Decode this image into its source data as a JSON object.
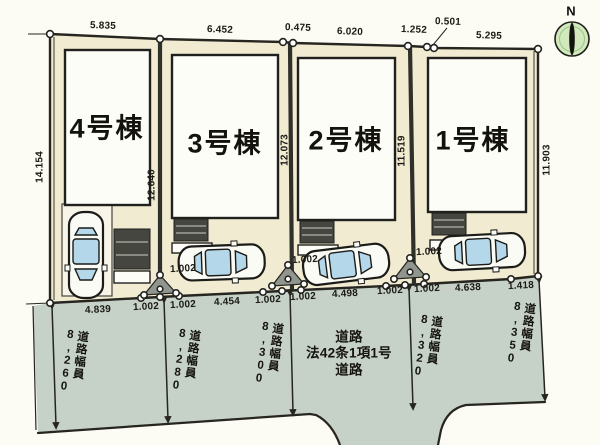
{
  "compass": {
    "north_label": "N"
  },
  "buildings": [
    {
      "label": "4号棟"
    },
    {
      "label": "3号棟"
    },
    {
      "label": "2号棟"
    },
    {
      "label": "1号棟"
    }
  ],
  "dimensions": {
    "top": [
      "5.835",
      "6.452",
      "0.475",
      "6.020",
      "1.252",
      "0.501",
      "5.295"
    ],
    "left_side": "14.154",
    "right_side": "11.903",
    "boundary_4_3": "12.640",
    "boundary_3_2": "12.073",
    "boundary_2_1": "11.519",
    "bottom": [
      "4.839",
      "1.002",
      "1.002",
      "4.454",
      "1.002",
      "1.002",
      "4.498",
      "1.002",
      "1.002",
      "4.638",
      "1.418"
    ],
    "access_strips": [
      "1.002",
      "1.002",
      "1.002"
    ]
  },
  "road": {
    "name_lines": [
      "道路",
      "法42条1項1号",
      "道路"
    ],
    "width_prefix": "道路幅員",
    "widths": [
      "8,260",
      "8,280",
      "8,300",
      "8,320",
      "8,350"
    ]
  },
  "colors": {
    "lot_fill": "#f1ebd2",
    "road_fill": "#c6d2c8",
    "building_fill": "#fdfdf8",
    "line": "#26251f",
    "porch_fill": "#45463f",
    "car_glass": "#b5d7ea",
    "compass_fill": "#d2e9bd"
  }
}
